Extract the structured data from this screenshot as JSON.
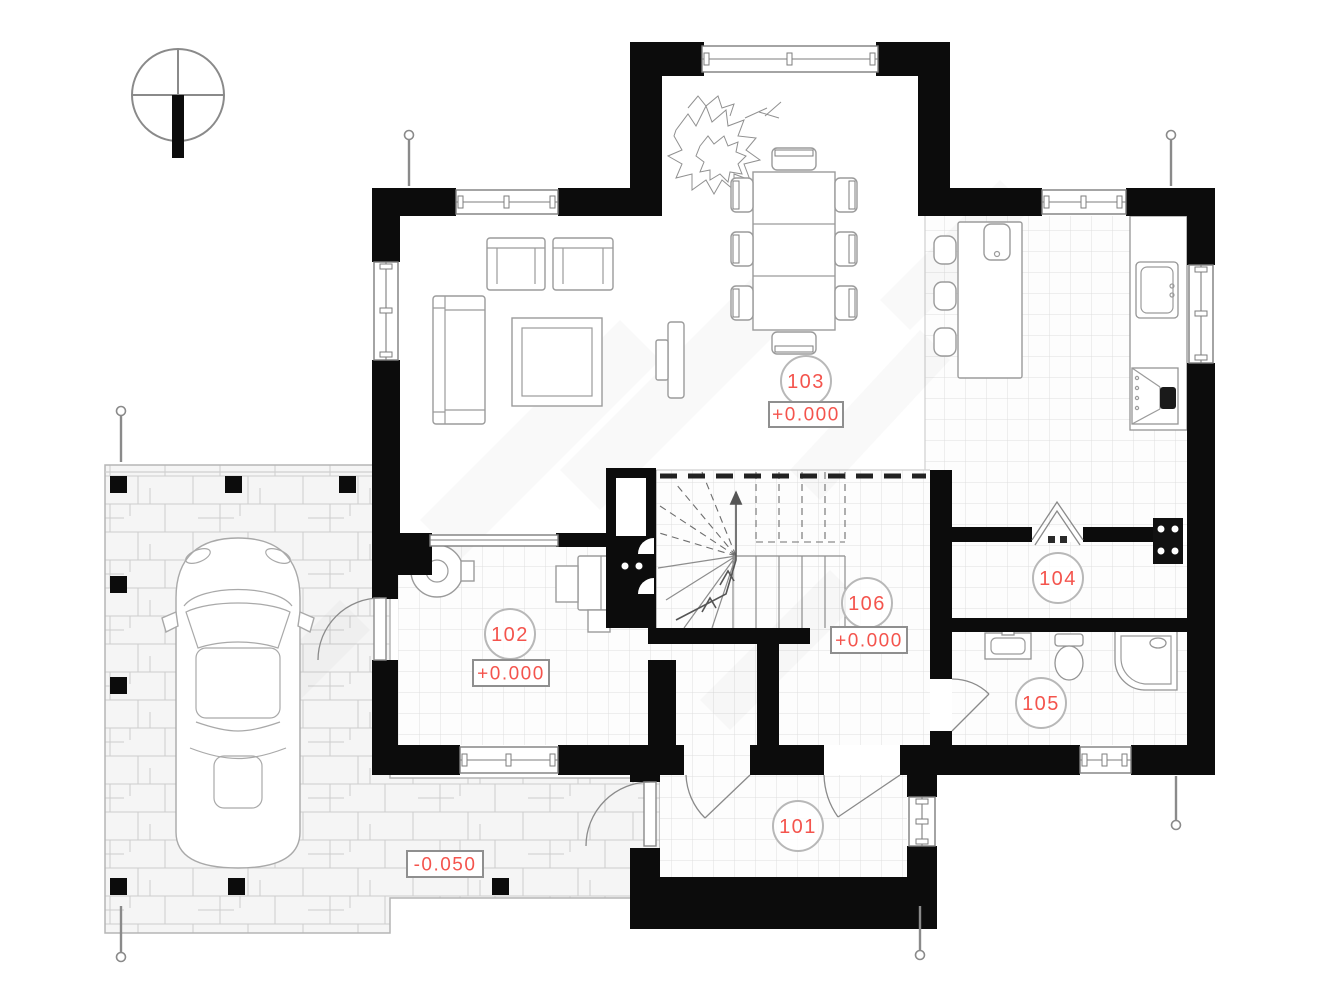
{
  "rooms": {
    "r101": {
      "number": "101"
    },
    "r102": {
      "number": "102",
      "elevation": "+0.000"
    },
    "r103": {
      "number": "103",
      "elevation": "+0.000"
    },
    "r104": {
      "number": "104"
    },
    "r105": {
      "number": "105"
    },
    "r106": {
      "number": "106",
      "elevation": "+0.000"
    }
  },
  "site": {
    "terrace_elevation": "-0.050"
  },
  "colors": {
    "label_red": "#f4544d",
    "wall_black": "#0c0c0c",
    "label_circle_gray": "#b8b8b8",
    "marker_box_border": "#8f8f8f",
    "tile_line": "#dedede",
    "furniture_line": "#9b9b9b"
  },
  "icons": {
    "north_arrow": "north-arrow-icon",
    "plant": "plant-scribble-icon",
    "car": "car-top-view-icon",
    "stairs": "winder-staircase-icon",
    "outlets": "electrical-outlet-icon"
  }
}
